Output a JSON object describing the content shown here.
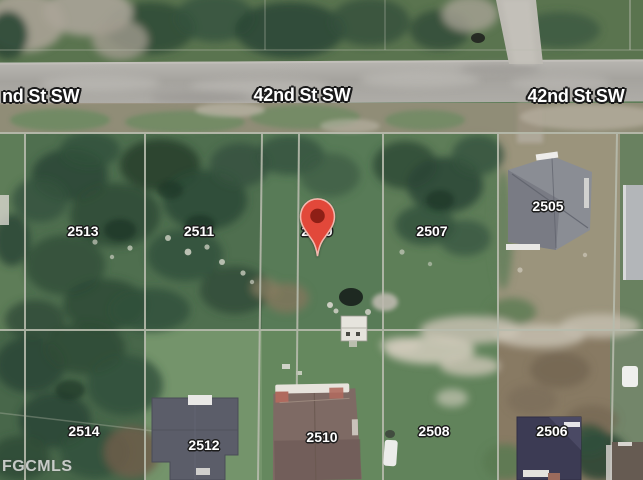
{
  "map": {
    "type": "satellite-parcel-view",
    "watermark": "FGCMLS",
    "street_labels": [
      {
        "text": "nd St SW"
      },
      {
        "text": "42nd St SW"
      },
      {
        "text": "42nd St SW"
      }
    ],
    "parcel_labels": [
      {
        "number": "2513"
      },
      {
        "number": "2511"
      },
      {
        "number": "2509"
      },
      {
        "number": "2507"
      },
      {
        "number": "2505"
      },
      {
        "number": "2514"
      },
      {
        "number": "2512"
      },
      {
        "number": "2510"
      },
      {
        "number": "2508"
      },
      {
        "number": "2506"
      }
    ],
    "marker": {
      "name": "map-pin",
      "color": "#e2483a",
      "inner_color": "#8e1f16",
      "outline_color": "#f2b8ae"
    },
    "colors": {
      "grass": "#5e7d58",
      "trees": "#2b4735",
      "road": "#aba9a4",
      "dirt_lot": "#8a7a64",
      "parcel_line": "#b7bbad"
    }
  }
}
